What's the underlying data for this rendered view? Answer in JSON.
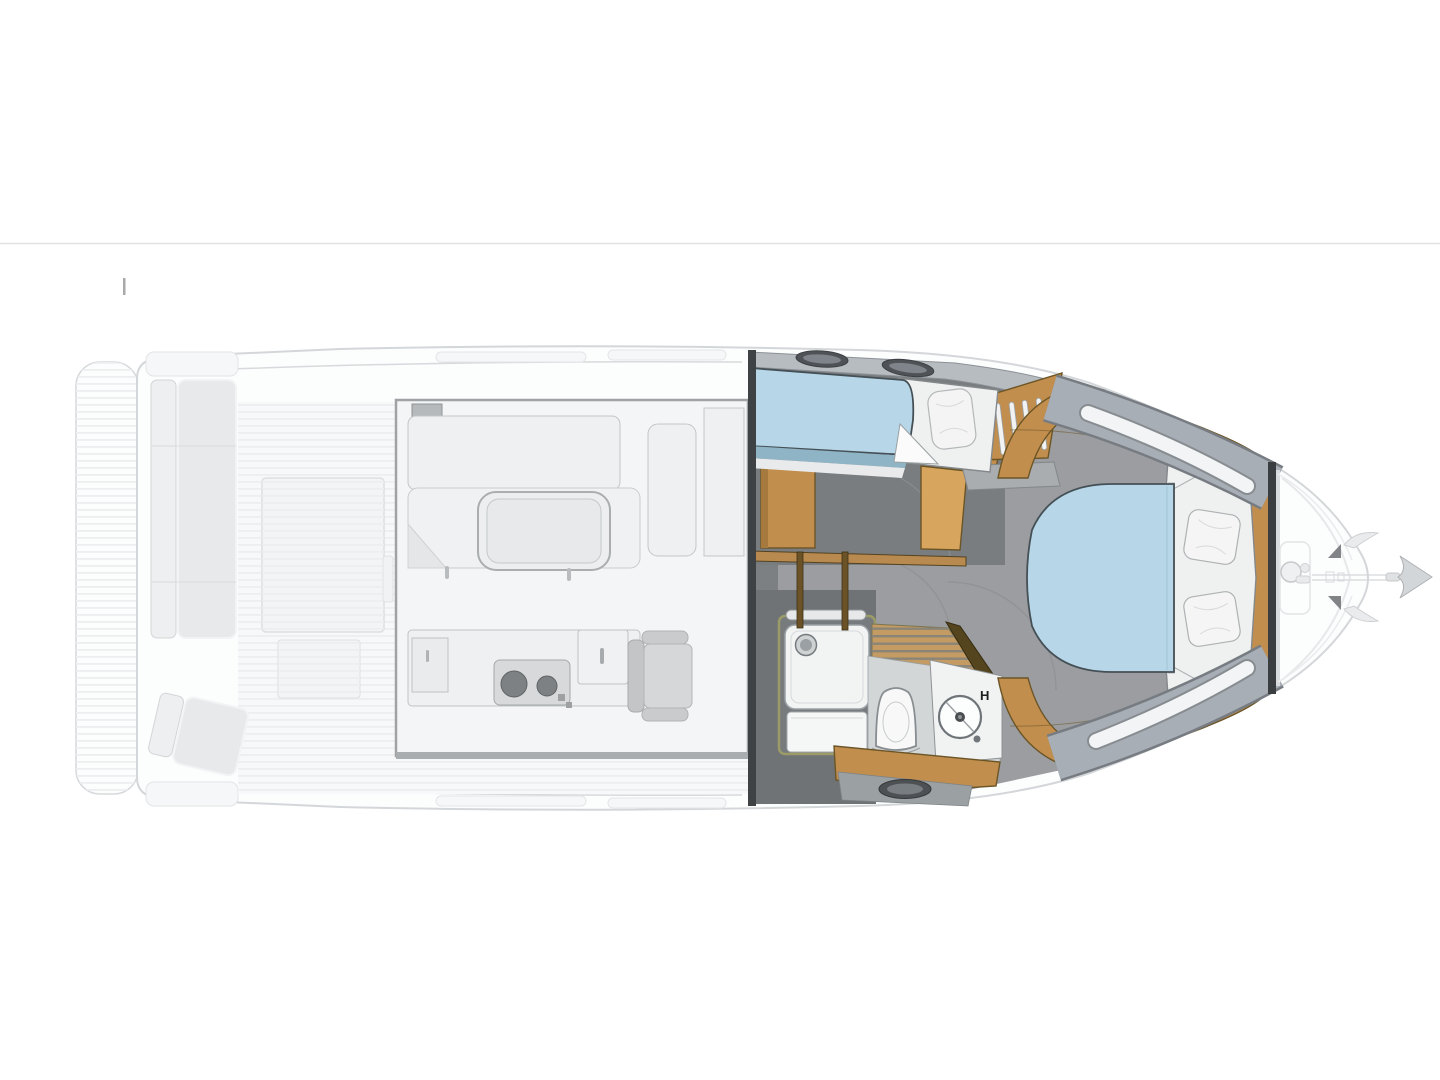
{
  "page": {
    "background": "#ffffff"
  },
  "divider": {
    "color": "#e2e2e2"
  },
  "labels": {
    "sink_hot_label": "H"
  },
  "colors": {
    "page_bg": "#ffffff",
    "divider": "#e2e2e2",
    "ghost_fill": "#fcfdfd",
    "ghost_line": "#d7dadc",
    "wood": "#c28e4e",
    "wood_light": "#d8a55f",
    "wood_dark": "#6b5526",
    "teak": "#c49b62",
    "mattress": "#b7d7e8",
    "mattress_shade": "#8fb4c6",
    "bedding": "#eff1f0",
    "floor": "#9b9da0",
    "wall": "#797d80",
    "deck_band": "#b7bcc1",
    "side_panel": "#a8aeb5",
    "window_slot": "#f2f4f5",
    "hatch": "#4d5154",
    "label": "#1c1e1f"
  }
}
